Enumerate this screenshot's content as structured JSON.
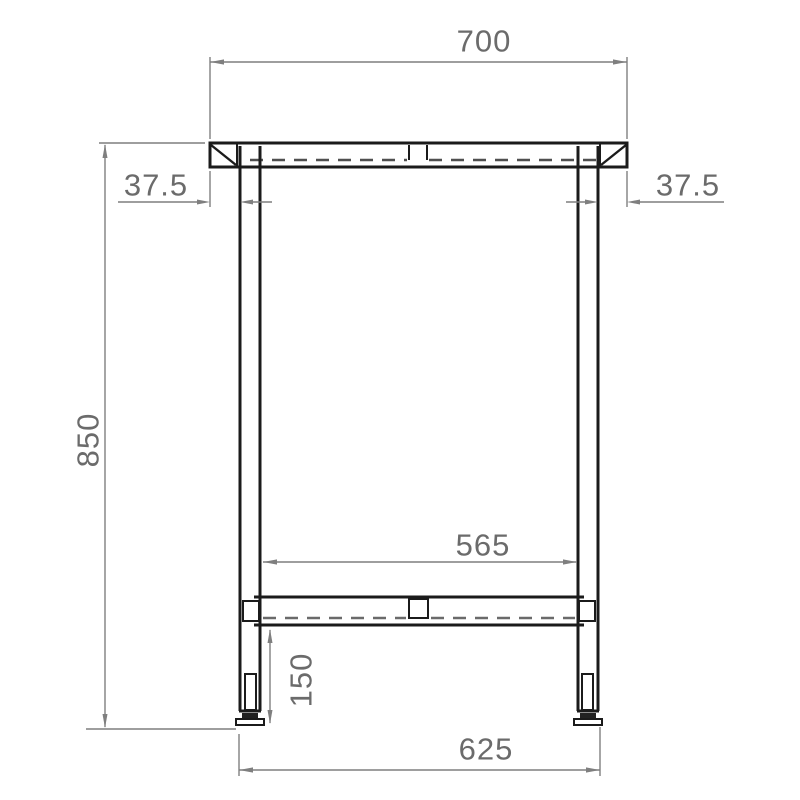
{
  "drawing": {
    "kind": "technical-drawing",
    "subject": "table-frame-front-elevation",
    "background_color": "#ffffff",
    "object_line_color": "#1b1b1b",
    "dimension_line_color": "#7f7f7f",
    "dimension_text_color": "#6b6b6b",
    "dimensions": {
      "top_width": {
        "value": "700",
        "orientation": "horizontal",
        "location": "top, overall tabletop width"
      },
      "left_overhang": {
        "value": "37.5",
        "orientation": "horizontal",
        "location": "left tabletop overhang past leg"
      },
      "right_overhang": {
        "value": "37.5",
        "orientation": "horizontal",
        "location": "right tabletop overhang past leg"
      },
      "overall_height": {
        "value": "850",
        "orientation": "vertical",
        "location": "left side, tabletop to floor"
      },
      "inner_width": {
        "value": "565",
        "orientation": "horizontal",
        "location": "clear span between legs"
      },
      "stretcher_height": {
        "value": "150",
        "orientation": "vertical",
        "location": "stretcher underside to floor"
      },
      "outer_leg_span": {
        "value": "625",
        "orientation": "horizontal",
        "location": "bottom, outside of feet"
      }
    }
  }
}
